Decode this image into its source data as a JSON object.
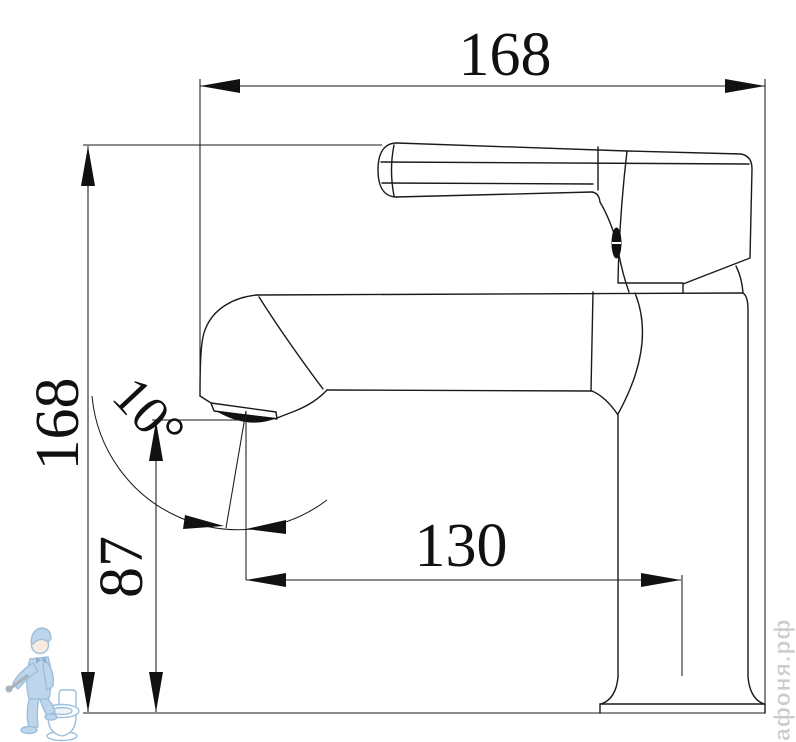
{
  "dimensions": {
    "top_width": "168",
    "left_height": "168",
    "spout_height": "87",
    "spout_reach": "130",
    "spout_angle": "10°"
  },
  "watermark": {
    "site": "афоня.рф"
  },
  "colors": {
    "line": "#1a1a1a",
    "dimension_text": "#111111",
    "watermark_blue": "#8db4d6",
    "watermark_fill": "#cde0f0",
    "watermark_gray": "#c9c9c9",
    "background": "#ffffff"
  }
}
